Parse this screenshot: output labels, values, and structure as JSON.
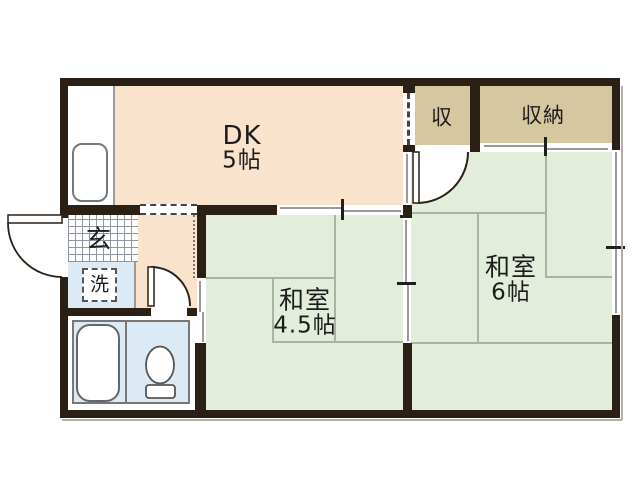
{
  "floorplan": {
    "type": "Japanese apartment floor plan",
    "rooms": {
      "dk": {
        "name": "DK",
        "size": "5帖",
        "color": "#fae3cd"
      },
      "washitsu6": {
        "name": "和室",
        "size": "6帖",
        "color": "#e2eedb"
      },
      "washitsu45": {
        "name": "和室",
        "size": "4.5帖",
        "color": "#e2eedb"
      },
      "closet_small": {
        "name": "収",
        "color": "#d7c7a0"
      },
      "closet_large": {
        "name": "収納",
        "color": "#d7c7a0"
      },
      "genkan": {
        "name": "玄"
      },
      "laundry": {
        "name": "洗",
        "color": "#dbeaf4"
      },
      "bathroom": {
        "color": "#dbeaf4"
      }
    },
    "fixtures": [
      "kitchen-sink",
      "bathtub",
      "toilet",
      "washing-machine-space",
      "entrance-door"
    ],
    "colors": {
      "wall": "#2b2016",
      "tatami_line": "#a9b5a4",
      "fixture_outline": "#777777",
      "background": "#ffffff"
    }
  }
}
